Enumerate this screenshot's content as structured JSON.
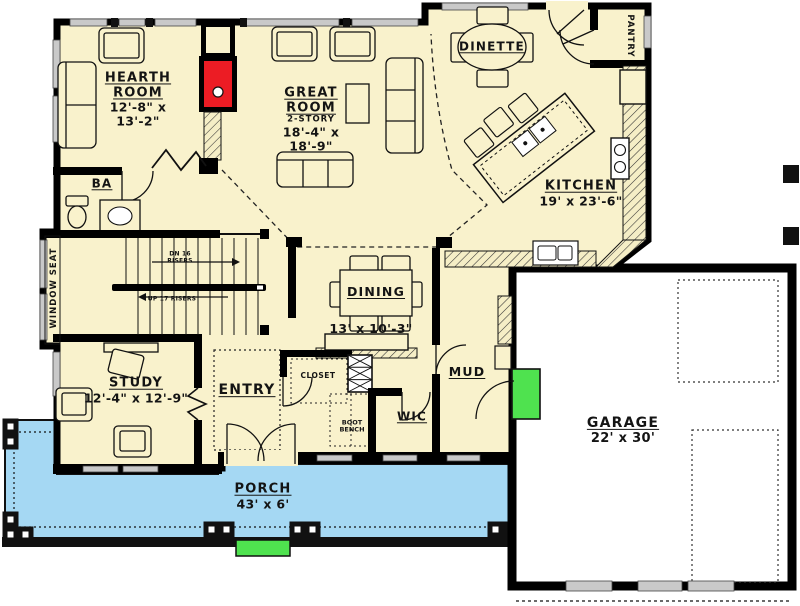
{
  "colors": {
    "floor": "#F9F2CC",
    "porch": "#A5D8F3",
    "garage_floor": "#FFFFFF",
    "wall": "#000000",
    "window_gray": "#C9C9C9",
    "highlight_green": "#4FE24F",
    "fireplace_red": "#EC1C24"
  },
  "rooms": {
    "hearth_room": {
      "name": "HEARTH ROOM",
      "dims": "12'-8\" x 13'-2\""
    },
    "great_room": {
      "name": "GREAT ROOM",
      "note": "2-STORY",
      "dims": "18'-4\" x 18'-9\""
    },
    "dinette": {
      "name": "DINETTE"
    },
    "pantry": {
      "name": "PANTRY"
    },
    "kitchen": {
      "name": "KITCHEN",
      "dims": "19' x 23'-6\""
    },
    "bath": {
      "name": "BA"
    },
    "window_seat": {
      "name": "WINDOW SEAT"
    },
    "dining": {
      "name": "DINING",
      "dims": "13' x 10'-3\""
    },
    "study": {
      "name": "STUDY",
      "dims": "12'-4\" x 12'-9\""
    },
    "entry": {
      "name": "ENTRY"
    },
    "closet": {
      "name": "CLOSET"
    },
    "boot_bench": {
      "name": "BOOT BENCH"
    },
    "wic": {
      "name": "WIC"
    },
    "mud": {
      "name": "MUD"
    },
    "garage": {
      "name": "GARAGE",
      "dims": "22' x 30'"
    },
    "porch": {
      "name": "PORCH",
      "dims": "43' x 6'"
    }
  },
  "stairs": {
    "down": "DN 16 RISERS",
    "up": "UP 17 RISERS"
  }
}
